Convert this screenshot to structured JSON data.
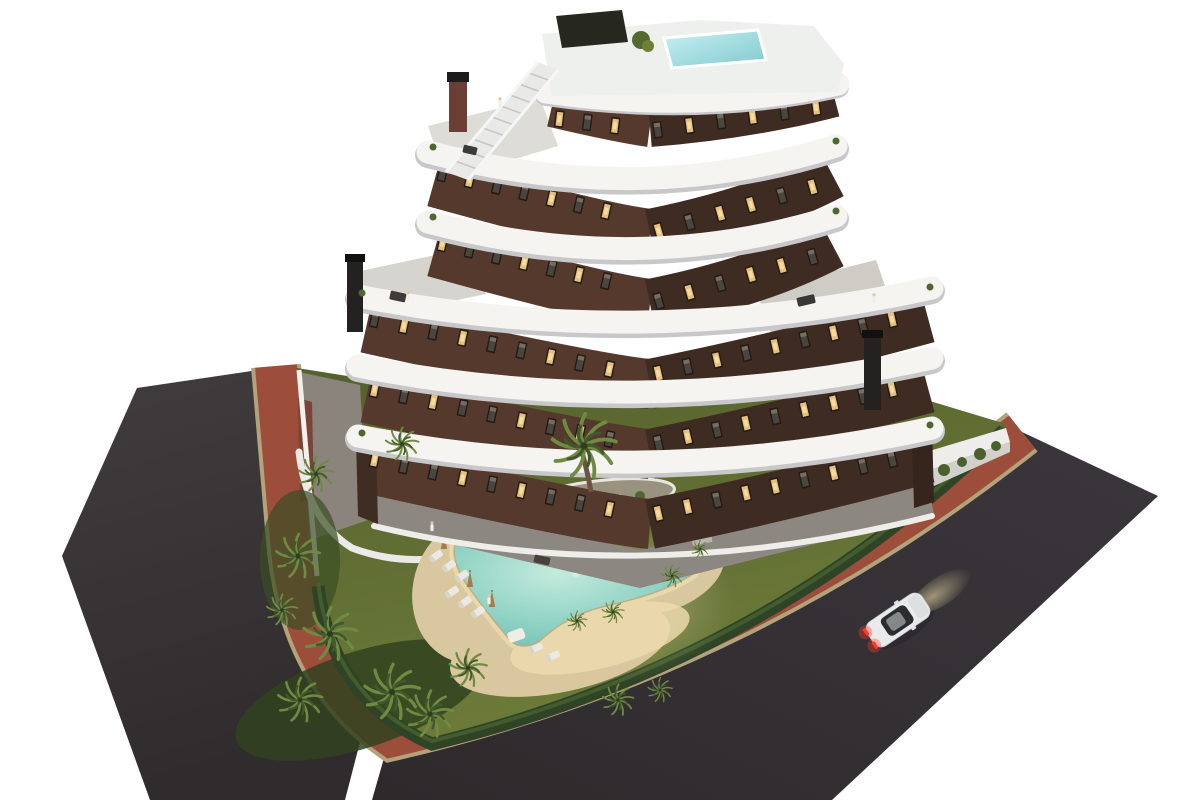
{
  "scene": {
    "type": "architectural-render",
    "description": "Aerial dusk rendering of a modern six-storey apartment building with curved white balcony bands, a rooftop plunge pool and exterior staircase, a landscaped garden with a glowing free-form lagoon pool, sun loungers and palm trees, a red perimeter pedestrian road, dark asphalt streets and a single white car with tail lights on.",
    "building": {
      "residential_floors": 6,
      "balcony_bands": 6,
      "rooftop_pool": true,
      "exterior_staircase": true,
      "chimneys": 3
    },
    "garden": {
      "pool_style": "free-form lagoon",
      "underwater_lights": 5,
      "sun_loungers": 8,
      "pool_sofas": 1,
      "parasols": 3,
      "planting_island": 1
    },
    "palm_trees": 16,
    "people_visible": 5,
    "vehicles": {
      "white_car": 1
    }
  },
  "colors": {
    "background": "#ffffff",
    "asphalt_top": "#413d3f",
    "asphalt_bottom": "#302c2e",
    "asphalt_right": "#3a363c",
    "asphalt_right_dark": "#2e2a2c",
    "curb_tan": "#b3a37c",
    "road_red": "#9d4e3b",
    "lawn_dark": "#55612d",
    "lawn": "#6e7c3a",
    "hedge": "#2f4326",
    "sand": "#d9c7a0",
    "sand_lit": "#ecd9ad",
    "pool_light": "#c4ebdd",
    "pool_mid": "#8fd2c4",
    "pool_deep": "#69b9ab",
    "facade": "#54392c",
    "facade_shadow": "#3e2b21",
    "band_white": "#f5f4f1",
    "band_shadow": "#c8c8ca",
    "deck_gray": "#8c8780",
    "window_dark": "#221b17",
    "window_lit": "#e6c07c",
    "rooftop_pool": "#9fdce0",
    "wall_white": "#efedea",
    "brick_wall": "#7a4336",
    "car_body": "#e9eaeb",
    "taillight": "#ff3826",
    "headlight": "#f6e6ae",
    "palm": "#6f8b42",
    "palm_dark": "#42582c",
    "trunk": "#6b5540"
  }
}
